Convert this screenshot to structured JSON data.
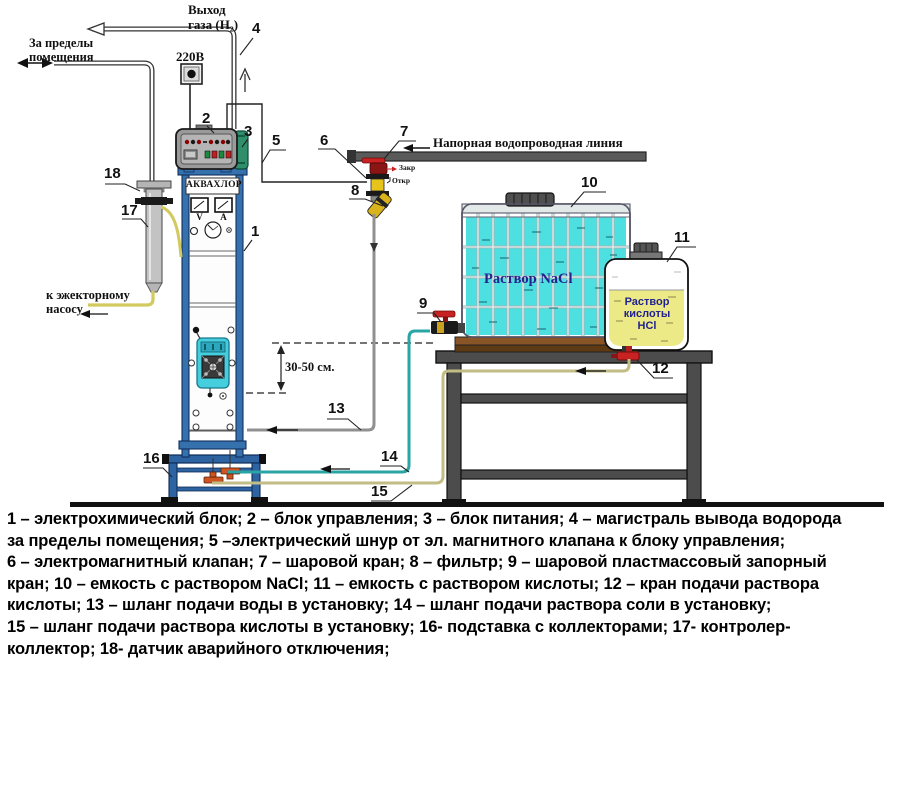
{
  "diagram": {
    "labels": {
      "gas_outlet_1": "Выход",
      "gas_outlet_2": "газа (H₂)",
      "outside_1": "За пределы",
      "outside_2": "помещения",
      "power": "220В",
      "device": "АКВАХЛОР",
      "volt": "V",
      "amp": "A",
      "water_line": "Напорная водопроводная линия",
      "valve_closed": "Закр",
      "valve_open": "Откр",
      "nacl": "Раствор NaCl",
      "acid_1": "Раствор",
      "acid_2": "кислоты",
      "acid_3": "HCl",
      "distance": "30-50 см.",
      "ejector_1": "к эжекторному",
      "ejector_2": "насосу"
    },
    "callouts": {
      "n1": "1",
      "n2": "2",
      "n3": "3",
      "n4": "4",
      "n5": "5",
      "n6": "6",
      "n7": "7",
      "n8": "8",
      "n9": "9",
      "n10": "10",
      "n11": "11",
      "n12": "12",
      "n13": "13",
      "n14": "14",
      "n15": "15",
      "n16": "16",
      "n17": "17",
      "n18": "18"
    },
    "colors": {
      "frame_blue": "#3571ad",
      "liquid_cyan": "#4ee0e0",
      "liquid_yellow": "#ece987",
      "valve_red": "#c92222",
      "hose_teal": "#2aa5a5",
      "hose_khaki": "#c2bd85",
      "label_navy": "#23238f"
    }
  },
  "legend": [
    "1 – электрохимический блок; 2 – блок управления; 3 – блок питания;  4 –  магистраль вывода водорода",
    "за пределы помещения; 5 –электрический шнур от эл. магнитного клапана к блоку управления;",
    "6 – электромагнитный клапан; 7 – шаровой кран; 8 – фильтр; 9 – шаровой пластмассовый запорный",
    "кран; 10 – емкость с раствором NaCl; 11 – емкость с раствором кислоты;  12 – кран подачи раствора",
    "кислоты; 13 – шланг подачи воды в установку; 14 – шланг подачи раствора соли в установку;",
    "15 – шланг подачи раствора кислоты в установку; 16- подставка с коллекторами; 17- контролер-",
    "коллектор; 18- датчик аварийного отключения;"
  ]
}
